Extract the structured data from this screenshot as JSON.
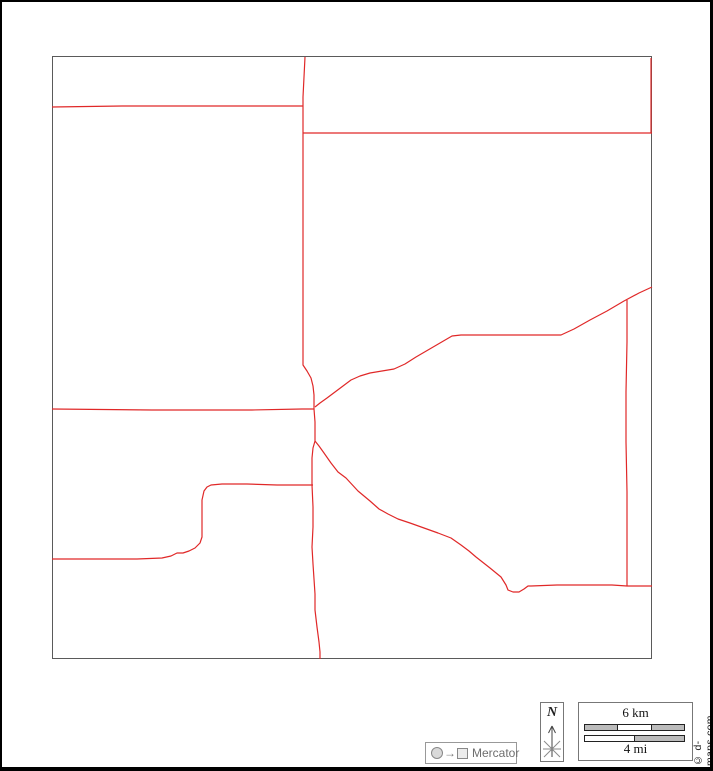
{
  "page": {
    "background": "#ffffff",
    "outer_border_color": "#000000"
  },
  "map": {
    "frame": {
      "x": 50,
      "y": 54,
      "width": 600,
      "height": 603,
      "border_color": "#5a5a5a"
    },
    "road_color": "#e02828",
    "roads": [
      {
        "id": "main-north-south-road",
        "points": [
          [
            303,
            55
          ],
          [
            302,
            75
          ],
          [
            301,
            95
          ],
          [
            301,
            104
          ],
          [
            301,
            131
          ],
          [
            301,
            180
          ],
          [
            301,
            240
          ],
          [
            301,
            300
          ],
          [
            301,
            340
          ],
          [
            301,
            363
          ],
          [
            305,
            369
          ],
          [
            309,
            376
          ],
          [
            311,
            384
          ],
          [
            312,
            393
          ],
          [
            312,
            407
          ],
          [
            313,
            420
          ],
          [
            313,
            432
          ],
          [
            313,
            439
          ],
          [
            311,
            446
          ],
          [
            310,
            456
          ],
          [
            310,
            468
          ],
          [
            310,
            483
          ],
          [
            311,
            505
          ],
          [
            311,
            525
          ],
          [
            310,
            545
          ],
          [
            311,
            562
          ],
          [
            312,
            577
          ],
          [
            313,
            592
          ],
          [
            313,
            608
          ],
          [
            315,
            625
          ],
          [
            317,
            640
          ],
          [
            318,
            650
          ],
          [
            318,
            657
          ]
        ]
      },
      {
        "id": "top-left-horizontal-road",
        "points": [
          [
            50,
            105
          ],
          [
            120,
            104
          ],
          [
            220,
            104
          ],
          [
            301,
            104
          ]
        ]
      },
      {
        "id": "top-right-horizontal-road",
        "points": [
          [
            301,
            131
          ],
          [
            400,
            131
          ],
          [
            520,
            131
          ],
          [
            650,
            131
          ]
        ]
      },
      {
        "id": "right-edge-road-segment",
        "points": [
          [
            649,
            56
          ],
          [
            649,
            95
          ],
          [
            649,
            131
          ]
        ]
      },
      {
        "id": "mid-left-horizontal-road",
        "points": [
          [
            50,
            407
          ],
          [
            150,
            408
          ],
          [
            250,
            408
          ],
          [
            300,
            407
          ],
          [
            312,
            407
          ]
        ]
      },
      {
        "id": "northeast-diagonal-road",
        "points": [
          [
            313,
            405
          ],
          [
            318,
            401
          ],
          [
            325,
            396
          ],
          [
            333,
            390
          ],
          [
            341,
            384
          ],
          [
            349,
            378
          ],
          [
            358,
            374
          ],
          [
            368,
            371
          ],
          [
            380,
            369
          ],
          [
            392,
            367
          ],
          [
            403,
            362
          ],
          [
            414,
            355
          ],
          [
            426,
            348
          ],
          [
            438,
            341
          ],
          [
            450,
            334
          ],
          [
            459,
            333
          ],
          [
            480,
            333
          ],
          [
            505,
            333
          ],
          [
            530,
            333
          ],
          [
            559,
            333
          ],
          [
            572,
            327
          ],
          [
            588,
            318
          ],
          [
            605,
            309
          ],
          [
            622,
            299
          ],
          [
            637,
            291
          ],
          [
            650,
            285
          ]
        ]
      },
      {
        "id": "right-vertical-road",
        "points": [
          [
            625,
            298
          ],
          [
            625,
            340
          ],
          [
            624,
            390
          ],
          [
            624,
            440
          ],
          [
            625,
            490
          ],
          [
            625,
            540
          ],
          [
            625,
            584
          ]
        ]
      },
      {
        "id": "bottom-right-horizontal-road",
        "points": [
          [
            529,
            584
          ],
          [
            555,
            583
          ],
          [
            585,
            583
          ],
          [
            610,
            583
          ],
          [
            625,
            584
          ],
          [
            650,
            584
          ]
        ]
      },
      {
        "id": "southeast-diagonal-road",
        "points": [
          [
            313,
            439
          ],
          [
            317,
            444
          ],
          [
            322,
            451
          ],
          [
            329,
            461
          ],
          [
            336,
            470
          ],
          [
            344,
            476
          ],
          [
            356,
            489
          ],
          [
            368,
            499
          ],
          [
            377,
            507
          ],
          [
            386,
            512
          ],
          [
            396,
            517
          ],
          [
            408,
            521
          ],
          [
            422,
            526
          ],
          [
            436,
            531
          ],
          [
            449,
            536
          ],
          [
            459,
            543
          ],
          [
            467,
            549
          ],
          [
            474,
            555
          ],
          [
            488,
            566
          ],
          [
            499,
            575
          ],
          [
            504,
            583
          ],
          [
            506,
            588
          ],
          [
            511,
            590
          ],
          [
            517,
            590
          ],
          [
            522,
            587
          ],
          [
            526,
            584
          ],
          [
            529,
            584
          ]
        ]
      },
      {
        "id": "bottom-left-road",
        "points": [
          [
            50,
            557
          ],
          [
            95,
            557
          ],
          [
            135,
            557
          ],
          [
            160,
            556
          ],
          [
            169,
            554
          ],
          [
            175,
            551
          ],
          [
            181,
            551
          ],
          [
            187,
            549
          ],
          [
            193,
            546
          ],
          [
            198,
            541
          ],
          [
            200,
            535
          ],
          [
            200,
            515
          ],
          [
            200,
            498
          ],
          [
            202,
            489
          ],
          [
            205,
            485
          ],
          [
            209,
            483
          ],
          [
            220,
            482
          ],
          [
            245,
            482
          ],
          [
            275,
            483
          ],
          [
            311,
            483
          ]
        ]
      }
    ]
  },
  "north": {
    "label": "N"
  },
  "scale": {
    "km_label": "6 km",
    "mi_label": "4 mi",
    "km_segments": [
      "#bbbbbb",
      "#ffffff",
      "#bbbbbb"
    ],
    "mi_segments": [
      "#ffffff",
      "#bbbbbb"
    ]
  },
  "projection": {
    "label": "Mercator",
    "arrow": "→"
  },
  "copyright": {
    "label": "© d-maps.com"
  }
}
